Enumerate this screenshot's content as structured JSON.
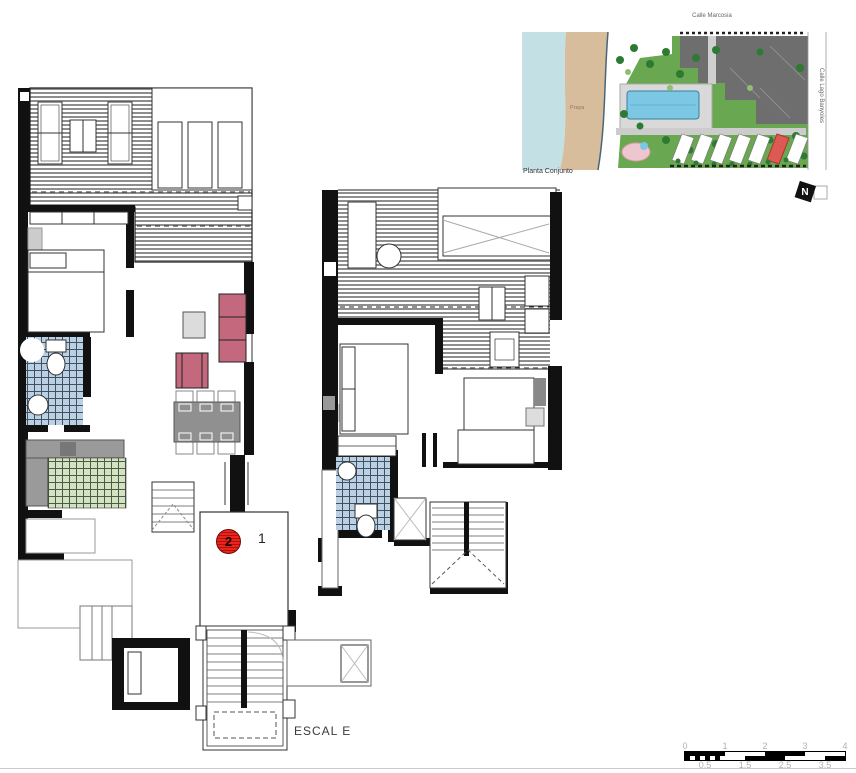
{
  "sheet": {
    "stair_label": "ESCAL E",
    "unit_highlight_number": "2",
    "unit_secondary_number": "1"
  },
  "site_plan": {
    "caption": "Planta Conjunto",
    "beach_label": "Praya",
    "street_top_label": "Calle Marcosia",
    "street_right_label": "Calle Lago Banyoles",
    "north_label": "N"
  },
  "scale_bar": {
    "top_ticks": [
      "0",
      "1",
      "2",
      "3",
      "4"
    ],
    "bottom_ticks": [
      "0.5",
      "1.5",
      "2.5",
      "3.5"
    ]
  },
  "colors": {
    "accent_red": "#e8251f",
    "sofa_pink": "#c4687e",
    "tile_blue": "#bad0e4",
    "tile_green": "#d2e3c4",
    "deck_stripe": "#8e8e8e",
    "wall_black": "#111111",
    "sea": "#c3e1e4",
    "beach": "#d7bd9c",
    "grass": "#69a751",
    "pool": "#7cc7e4",
    "building_roof": "#6e6e6e",
    "highlight_unit": "#dd5a52",
    "scale_text": "#b0b0b0"
  }
}
